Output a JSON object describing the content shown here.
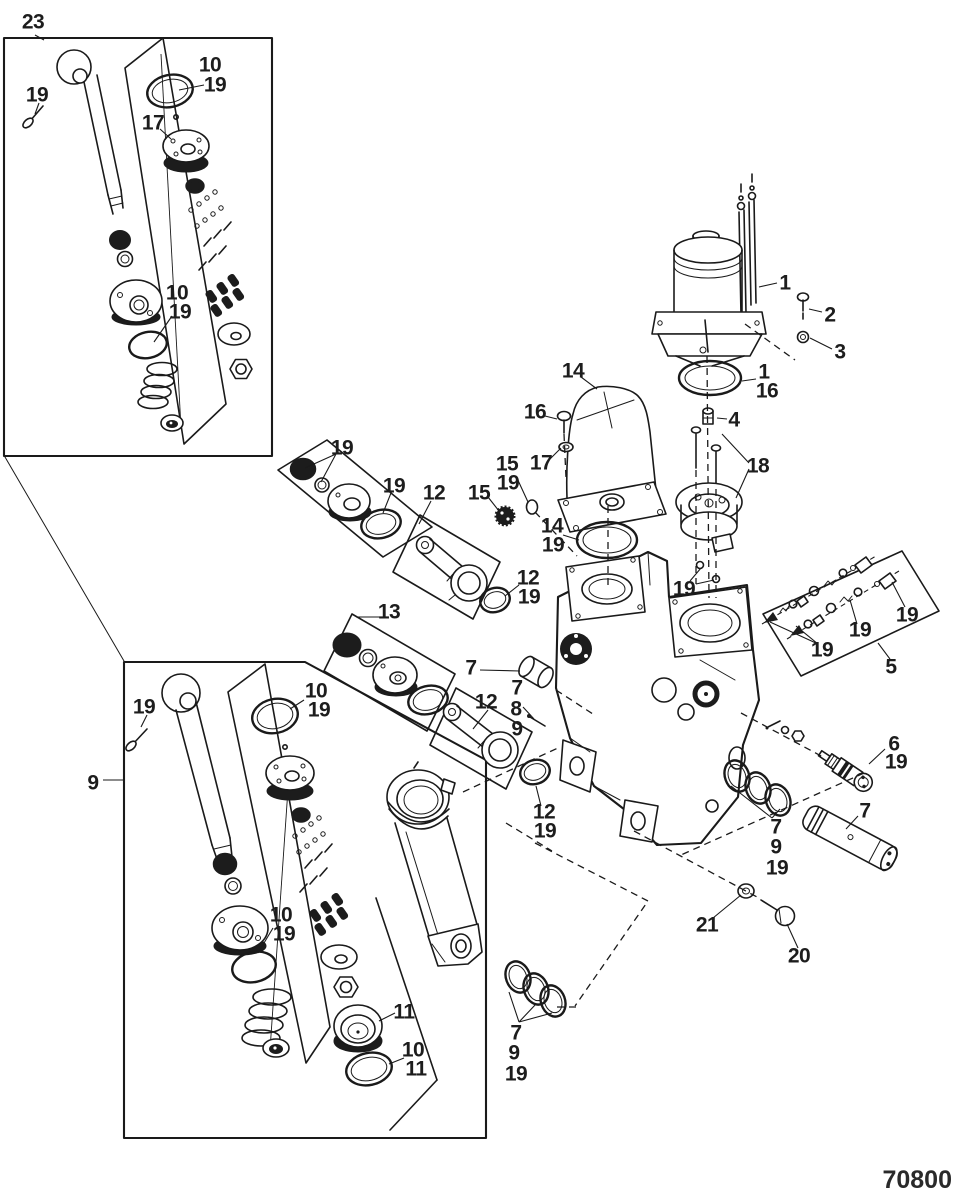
{
  "drawing_number": "70800",
  "diagram_type": "exploded-parts-diagram",
  "callouts": [
    {
      "text": "23",
      "x": 33,
      "y": 22,
      "size": 30
    },
    {
      "text": "19",
      "x": 37,
      "y": 95
    },
    {
      "text": "10",
      "x": 210,
      "y": 65
    },
    {
      "text": "19",
      "x": 215,
      "y": 85
    },
    {
      "text": "17",
      "x": 153,
      "y": 123
    },
    {
      "text": "10",
      "x": 177,
      "y": 293
    },
    {
      "text": "19",
      "x": 180,
      "y": 312
    },
    {
      "text": "19",
      "x": 342,
      "y": 448
    },
    {
      "text": "19",
      "x": 394,
      "y": 486
    },
    {
      "text": "12",
      "x": 434,
      "y": 493
    },
    {
      "text": "13",
      "x": 389,
      "y": 612
    },
    {
      "text": "7",
      "x": 471,
      "y": 668
    },
    {
      "text": "7",
      "x": 517,
      "y": 688
    },
    {
      "text": "8",
      "x": 516,
      "y": 709
    },
    {
      "text": "9",
      "x": 517,
      "y": 729
    },
    {
      "text": "12",
      "x": 486,
      "y": 702
    },
    {
      "text": "12",
      "x": 528,
      "y": 578
    },
    {
      "text": "19",
      "x": 529,
      "y": 597
    },
    {
      "text": "12",
      "x": 544,
      "y": 812
    },
    {
      "text": "19",
      "x": 545,
      "y": 831
    },
    {
      "text": "14",
      "x": 573,
      "y": 371
    },
    {
      "text": "16",
      "x": 535,
      "y": 412
    },
    {
      "text": "17",
      "x": 541,
      "y": 463
    },
    {
      "text": "15",
      "x": 507,
      "y": 464
    },
    {
      "text": "19",
      "x": 508,
      "y": 483
    },
    {
      "text": "15",
      "x": 479,
      "y": 493
    },
    {
      "text": "14",
      "x": 552,
      "y": 526
    },
    {
      "text": "19",
      "x": 553,
      "y": 545
    },
    {
      "text": "1",
      "x": 785,
      "y": 283
    },
    {
      "text": "2",
      "x": 830,
      "y": 315
    },
    {
      "text": "3",
      "x": 840,
      "y": 352
    },
    {
      "text": "1",
      "x": 764,
      "y": 372
    },
    {
      "text": "16",
      "x": 767,
      "y": 391
    },
    {
      "text": "4",
      "x": 734,
      "y": 420
    },
    {
      "text": "18",
      "x": 758,
      "y": 466
    },
    {
      "text": "19",
      "x": 684,
      "y": 589
    },
    {
      "text": "19",
      "x": 822,
      "y": 650
    },
    {
      "text": "19",
      "x": 860,
      "y": 630
    },
    {
      "text": "19",
      "x": 907,
      "y": 615
    },
    {
      "text": "5",
      "x": 891,
      "y": 667
    },
    {
      "text": "6",
      "x": 894,
      "y": 744
    },
    {
      "text": "19",
      "x": 896,
      "y": 762
    },
    {
      "text": "7",
      "x": 865,
      "y": 811
    },
    {
      "text": "7",
      "x": 776,
      "y": 827
    },
    {
      "text": "9",
      "x": 776,
      "y": 847
    },
    {
      "text": "19",
      "x": 777,
      "y": 868
    },
    {
      "text": "21",
      "x": 707,
      "y": 925
    },
    {
      "text": "20",
      "x": 799,
      "y": 956
    },
    {
      "text": "19",
      "x": 144,
      "y": 707
    },
    {
      "text": "9",
      "x": 93,
      "y": 783
    },
    {
      "text": "10",
      "x": 316,
      "y": 691
    },
    {
      "text": "19",
      "x": 319,
      "y": 710
    },
    {
      "text": "10",
      "x": 281,
      "y": 915
    },
    {
      "text": "19",
      "x": 284,
      "y": 934
    },
    {
      "text": "11",
      "x": 404,
      "y": 1012
    },
    {
      "text": "10",
      "x": 413,
      "y": 1050
    },
    {
      "text": "11",
      "x": 416,
      "y": 1069
    },
    {
      "text": "7",
      "x": 516,
      "y": 1033
    },
    {
      "text": "9",
      "x": 514,
      "y": 1053
    },
    {
      "text": "19",
      "x": 516,
      "y": 1074
    }
  ]
}
